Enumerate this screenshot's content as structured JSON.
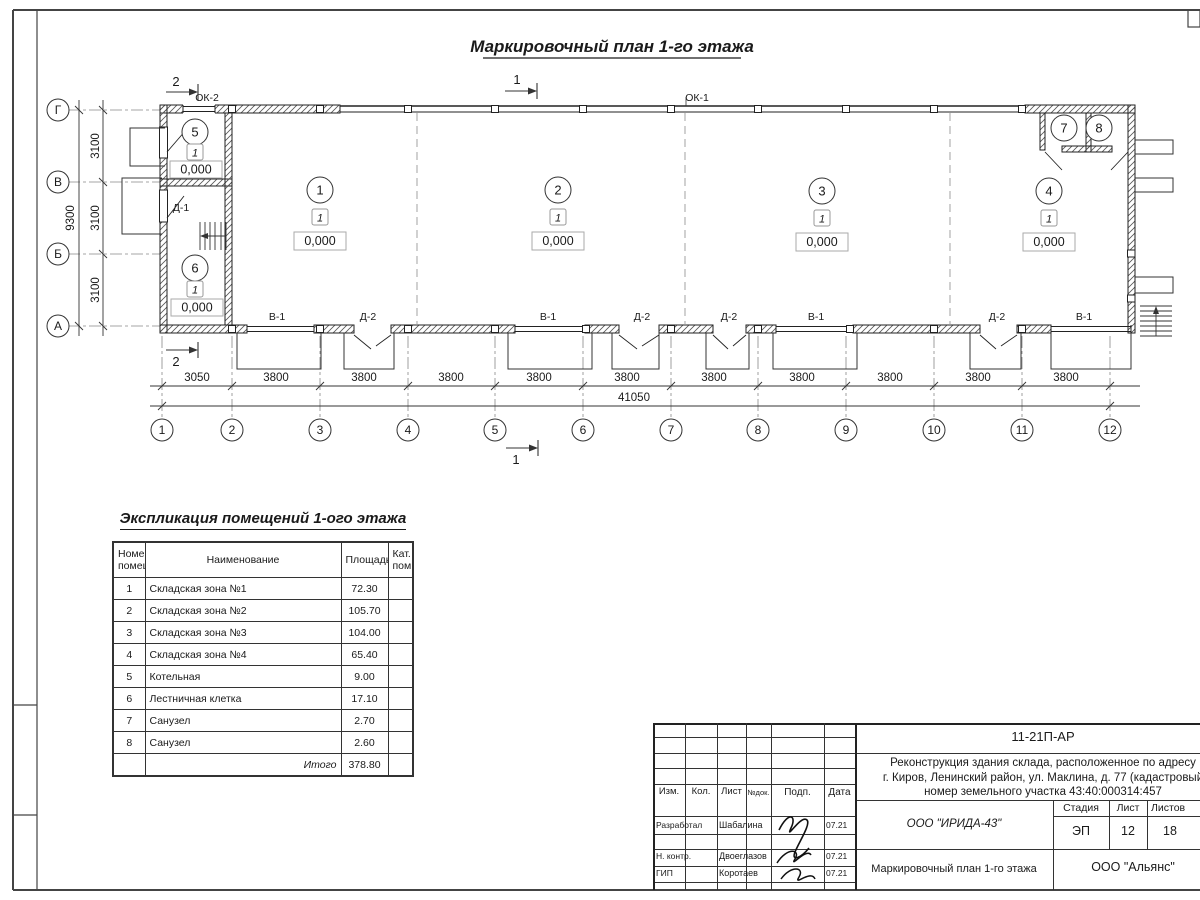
{
  "plan": {
    "title": "Маркировочный план 1-го этажа",
    "grid_cols": [
      "1",
      "2",
      "3",
      "4",
      "5",
      "6",
      "7",
      "8",
      "9",
      "10",
      "11",
      "12"
    ],
    "grid_rows": [
      "Г",
      "В",
      "Б",
      "А"
    ],
    "dims_bottom": [
      "3050",
      "3800",
      "3800",
      "3800",
      "3800",
      "3800",
      "3800",
      "3800",
      "3800",
      "3800",
      "3800"
    ],
    "dim_total_bottom": "41050",
    "dims_left": [
      "3100",
      "3100",
      "3100"
    ],
    "dim_total_left": "9300",
    "rooms": [
      {
        "num": "1",
        "type": "1",
        "level": "0,000"
      },
      {
        "num": "2",
        "type": "1",
        "level": "0,000"
      },
      {
        "num": "3",
        "type": "1",
        "level": "0,000"
      },
      {
        "num": "4",
        "type": "1",
        "level": "0,000"
      },
      {
        "num": "5",
        "type": "1",
        "level": "0,000"
      },
      {
        "num": "6",
        "type": "1",
        "level": "0,000"
      },
      {
        "num": "7"
      },
      {
        "num": "8"
      }
    ],
    "openings": {
      "ok1": "ОК-1",
      "ok2": "ОК-2",
      "d1": "Д-1",
      "bottom": [
        "В-1",
        "Д-2",
        "В-1",
        "Д-2",
        "Д-2",
        "В-1",
        "Д-2",
        "В-1"
      ]
    },
    "sections": {
      "s1": "1",
      "s2": "2"
    }
  },
  "explication": {
    "title": "Экспликация помещений 1-ого этажа",
    "headers": {
      "num_l1": "Номер",
      "num_l2": "помещ.",
      "name": "Наименование",
      "area": "Площадь",
      "cat_l1": "Кат.",
      "cat_l2": "пом."
    },
    "rows": [
      {
        "num": "1",
        "name": "Складская зона №1",
        "area": "72.30"
      },
      {
        "num": "2",
        "name": "Складская зона №2",
        "area": "105.70"
      },
      {
        "num": "3",
        "name": "Складская зона №3",
        "area": "104.00"
      },
      {
        "num": "4",
        "name": "Складская зона №4",
        "area": "65.40"
      },
      {
        "num": "5",
        "name": "Котельная",
        "area": "9.00"
      },
      {
        "num": "6",
        "name": "Лестничная клетка",
        "area": "17.10"
      },
      {
        "num": "7",
        "name": "Санузел",
        "area": "2.70"
      },
      {
        "num": "8",
        "name": "Санузел",
        "area": "2.60"
      }
    ],
    "total_label": "Итого",
    "total_value": "378.80"
  },
  "titleblock": {
    "code": "11-21П-АР",
    "project_l1": "Реконструкция здания склада, расположенное по адресу",
    "project_l2": "г. Киров, Ленинский район, ул. Маклина, д. 77 (кадастровый",
    "project_l3": "номер земельного участка 43:40:000314:457",
    "org": "ООО \"ИРИДА-43\"",
    "doc_title": "Маркировочный план 1-го этажа",
    "client": "ООО \"Альянс\"",
    "h_izm": "Изм.",
    "h_kol": "Кол.",
    "h_list": "Лист",
    "h_ndok": "№док.",
    "h_podp": "Подп.",
    "h_data": "Дата",
    "h_stage": "Стадия",
    "h_sheet": "Лист",
    "h_sheets": "Листов",
    "stage": "ЭП",
    "sheet": "12",
    "sheets": "18",
    "signers": [
      {
        "role": "Разработал",
        "name": "Шабалина",
        "date": "07.21"
      },
      {
        "role": "Н. контр.",
        "name": "Двоеглазов",
        "date": "07.21"
      },
      {
        "role": "ГИП",
        "name": "Коротаев",
        "date": "07.21"
      }
    ]
  }
}
